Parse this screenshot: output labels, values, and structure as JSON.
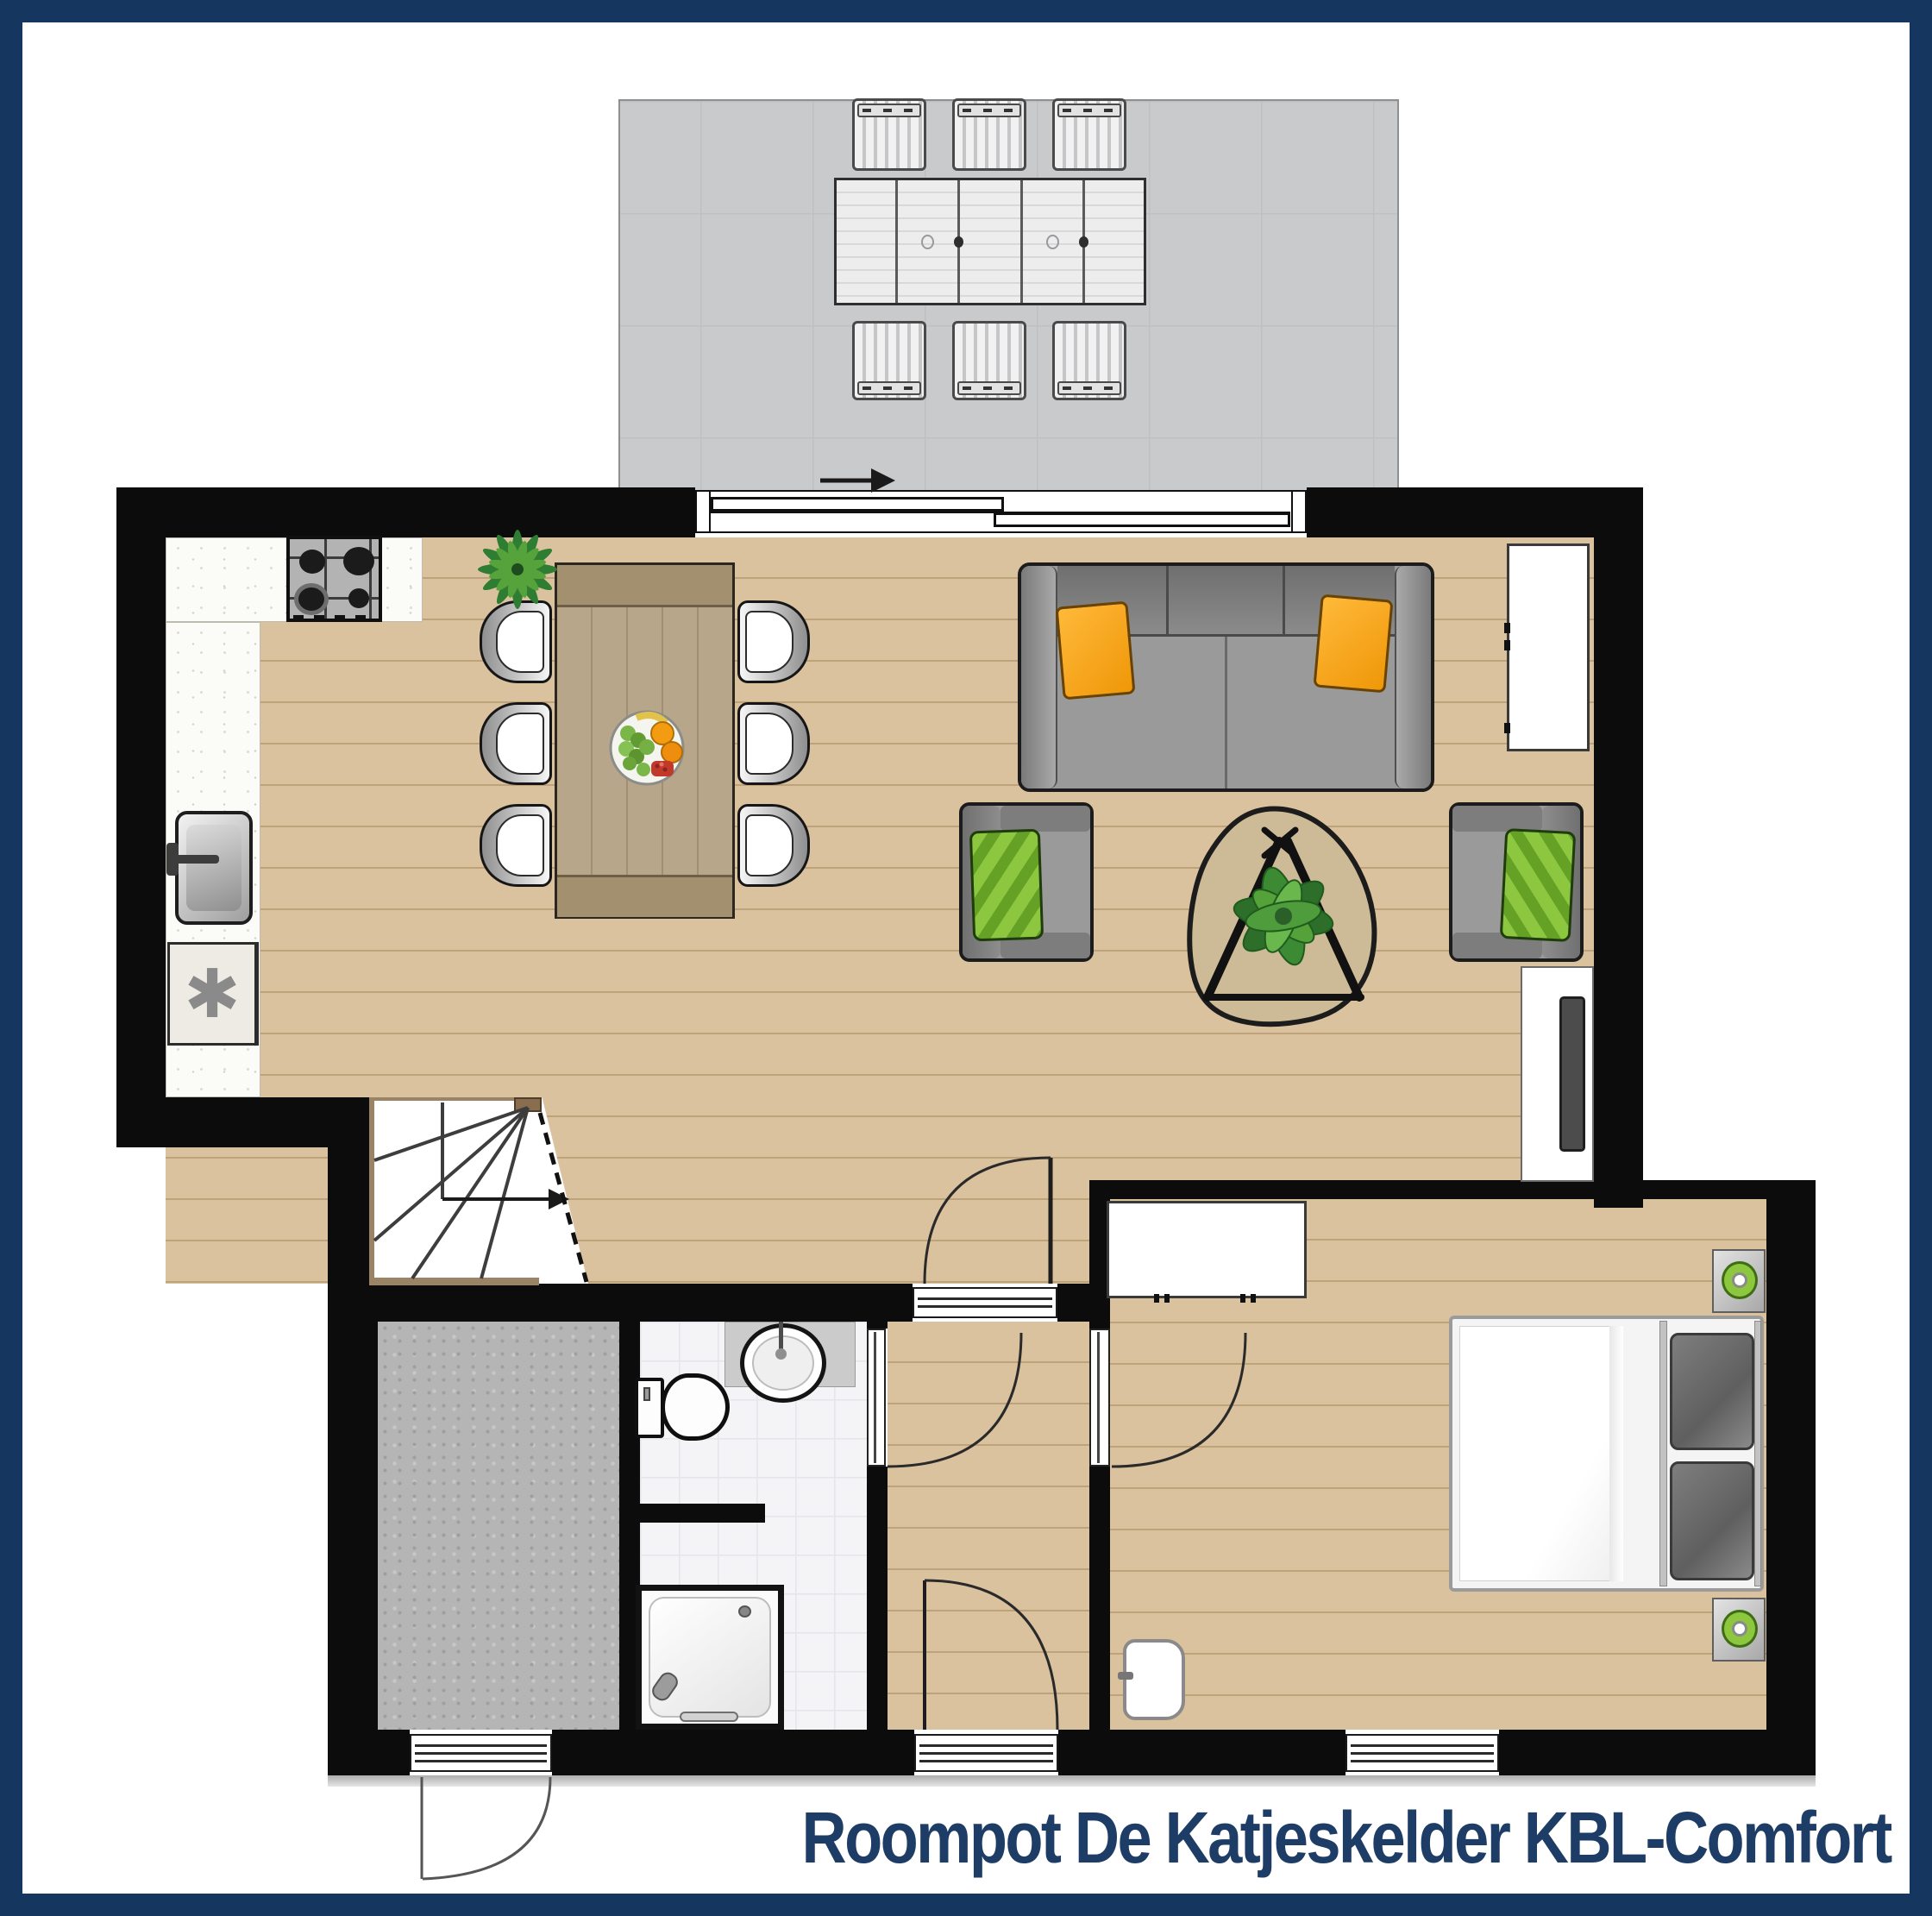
{
  "title": {
    "text": "Roompot De Katjeskelder KBL-Comfort",
    "color": "#1d3d66"
  },
  "symbols": {
    "freezer_glyph": "✱"
  },
  "colors": {
    "frame_navy": "#14365f",
    "wall_black": "#0c0c0c",
    "wood_floor": "#dac29e",
    "terrace_gray": "#c9cacb",
    "bath_tile": "#f4f4f6",
    "storage_gray": "#b5b5b5",
    "sofa_gray": "#8e8e8e",
    "pillow_orange": "#f6a61c",
    "pillow_green": "#8dc63f",
    "dining_table_wood": "#b7a68a",
    "coffee_table_wood": "#cdbb97",
    "plant_green": "#3f8c33",
    "knob_green": "#8dc63f"
  }
}
